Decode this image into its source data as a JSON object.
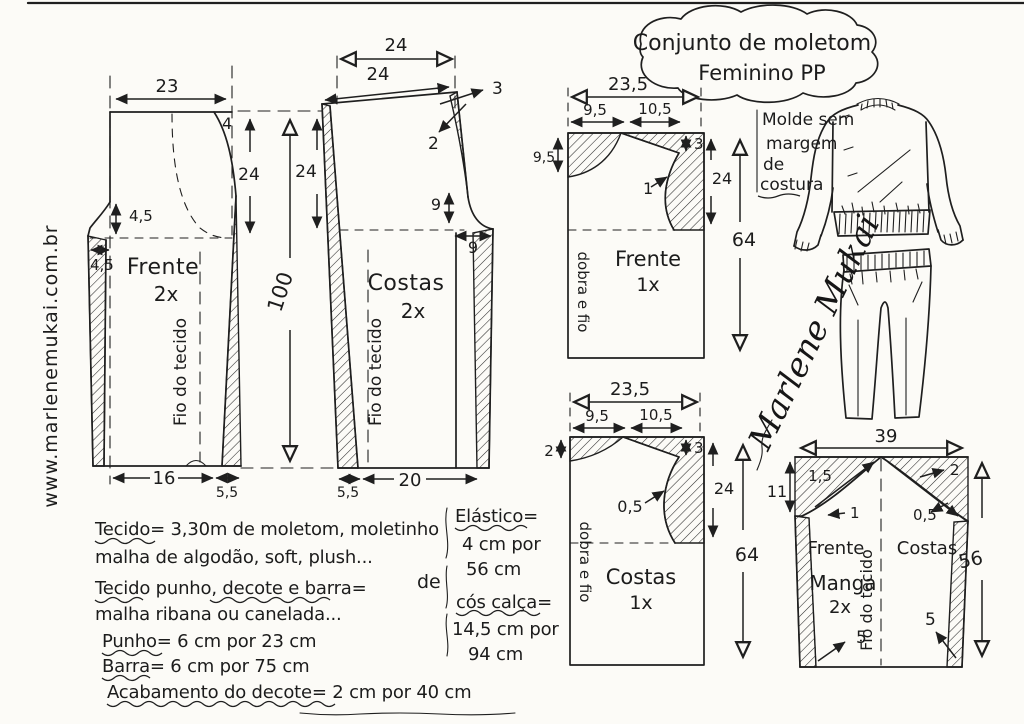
{
  "sheet": {
    "title_line1": "Conjunto de moletom",
    "title_line2": "Feminino PP",
    "website": "www.marlenemukai.com.br",
    "note_line1": "Molde sem",
    "note_line2": "margem",
    "note_line3": "de",
    "note_line4": "costura",
    "signature": "Marlene Mukai"
  },
  "pants_front": {
    "name": "Frente",
    "qty": "2x",
    "grain": "Fio do tecido",
    "top_width": "23",
    "top_curve": "4",
    "rise": "24",
    "hip_depth": "4,5",
    "hip_width": "4,5",
    "hem_width": "16",
    "hem_allow": "5,5"
  },
  "pants_length": "100",
  "pants_back": {
    "name": "Costas",
    "qty": "2x",
    "grain": "Fio do tecido",
    "waist_guide": "24",
    "waist_slant": "24",
    "raise": "3",
    "seam": "2",
    "rise": "24",
    "crotch_depth": "9",
    "crotch_width": "9",
    "hem_allow": "5,5",
    "hem_width": "20"
  },
  "top_front": {
    "name": "Frente",
    "qty": "1x",
    "fold": "dobra e fio",
    "width": "23,5",
    "neck_width": "9,5",
    "shoulder_width": "10,5",
    "neck_depth": "9,5",
    "shoulder_drop": "3",
    "ease": "1",
    "armhole": "24",
    "length": "64"
  },
  "top_back": {
    "name": "Costas",
    "qty": "1x",
    "fold": "dobra e fio",
    "width": "23,5",
    "neck_width": "9,5",
    "shoulder_width": "10,5",
    "neck_depth": "2",
    "shoulder_drop": "3",
    "ease": "0,5",
    "armhole": "24",
    "length": "64"
  },
  "sleeve": {
    "name": "Manga",
    "qty": "2x",
    "grain": "Fio do tecido",
    "width": "39",
    "cap_height": "11",
    "cap_front_1": "1,5",
    "cap_front_2": "1",
    "cap_back_1": "2",
    "cap_back_2": "0,5",
    "front_label": "Frente",
    "back_label": "Costas",
    "hem_taper_left": "5",
    "hem_taper_right": "5",
    "length": "56"
  },
  "notes": {
    "fabric_line1": "Tecido= 3,30m de moletom, moletinho",
    "fabric_line2": "malha de algodão, soft, plush...",
    "rib_line1": "Tecido punho, decote e barra=",
    "rib_line2": "malha ribana ou canelada...",
    "cuff": "Punho= 6 cm por 23 cm",
    "hem": "Barra= 6 cm por 75 cm",
    "neckline": "Acabamento do decote= 2 cm por 40 cm",
    "de": "de",
    "elastic_label": "Elástico=",
    "elastic_line1": "4 cm por",
    "elastic_line2": "56 cm",
    "waistband_label": "cós calça=",
    "waistband_line1": "14,5 cm por",
    "waistband_line2": "94 cm"
  }
}
